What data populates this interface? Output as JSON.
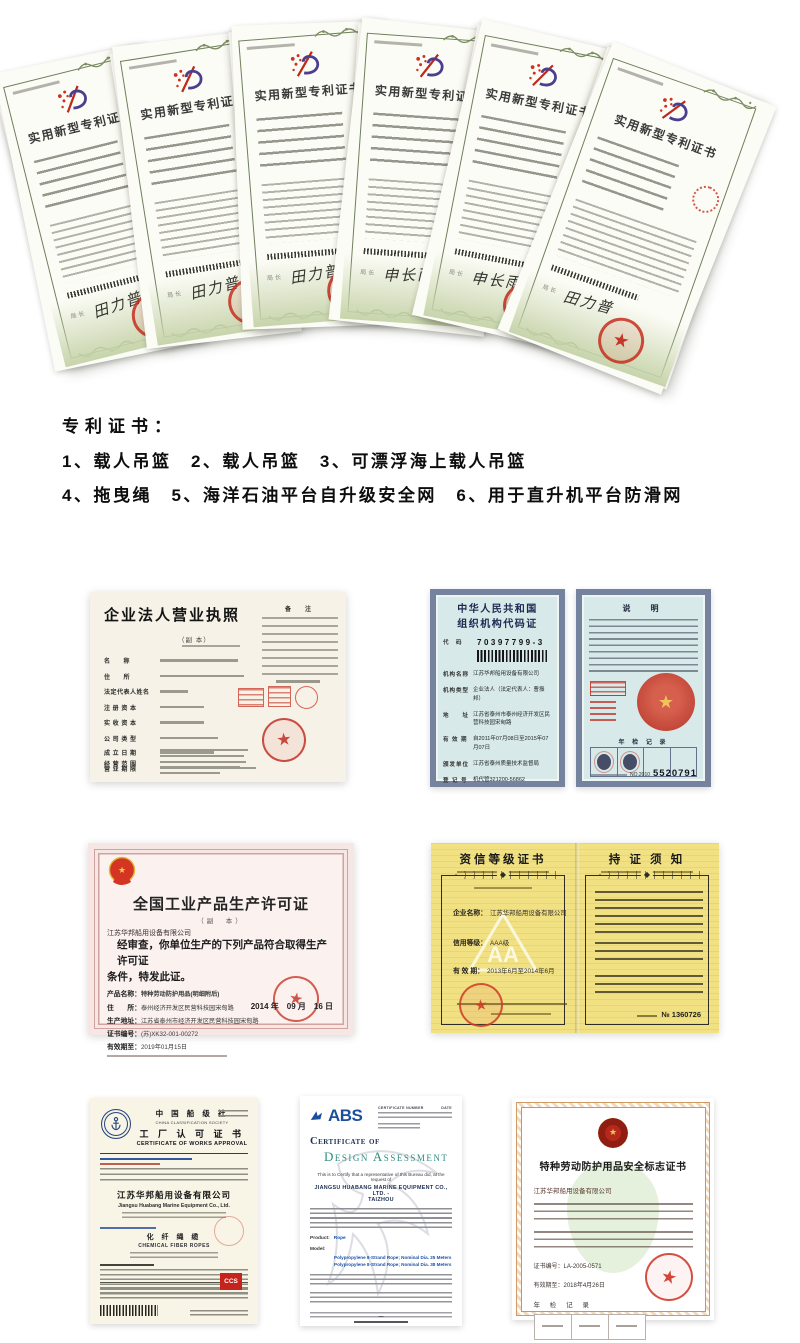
{
  "patent_stack": {
    "title": "实用新型专利证书",
    "issuer_label": "局长",
    "signature_a": "田力普",
    "signature_b": "申长雨"
  },
  "patent_list": {
    "heading": "专利证书：",
    "line1": "1、载人吊篮　2、载人吊篮　3、可漂浮海上载人吊篮",
    "line2": "4、拖曳绳　5、海洋石油平台自升级安全网　6、用于直升机平台防滑网"
  },
  "business_license": {
    "title": "企业法人营业执照",
    "copy_label": "（副  本）",
    "note_header": "备　注",
    "labels": [
      "名　　称",
      "住　　所",
      "法定代表人姓名",
      "注 册 资 本",
      "实 收 资 本",
      "公 司 类 型",
      "经 营 范 围"
    ],
    "footer_labels": [
      "成 立 日 期",
      "营 业 期 限"
    ]
  },
  "org_code_cert": {
    "title_line1": "中华人民共和国",
    "title_line2": "组织机构代码证",
    "code_label": "代　码",
    "code_value": "70397799-3",
    "labels": {
      "org_name": "机构名称",
      "org_type": "机构类型",
      "address": "地　　址",
      "validity": "有 效 期",
      "issuer": "颁发单位",
      "reg_no": "登 记 号"
    },
    "values": {
      "org_name": "江苏华邦船用设备有限公司",
      "org_type": "企业法人（法定代表人：曹振邦）",
      "address": "江苏省泰州市泰州经济开发区民营科技园宋甸路",
      "validity": "自2011年07月08日至2015年07月07日",
      "issuer": "江苏省泰州质量技术监督局",
      "reg_no": "机代管321200-56862"
    },
    "back": {
      "header": "说　明",
      "emblem_star": "★",
      "annual_label": "年 检 记 录",
      "serial_prefix": "NO.2010",
      "serial_number": "5520791"
    }
  },
  "production_license": {
    "title": "全国工业产品生产许可证",
    "copy_label": "（副　本）",
    "company": "江苏华邦船用设备有限公司",
    "statement_line1": "经审查，你单位生产的下列产品符合取得生产许可证",
    "statement_line2": "条件，特发此证。",
    "product_label": "产品名称：",
    "product_value": "特种劳动防护用品(明细附后)",
    "address_label": "住　　所：",
    "address_value": "泰州经济开发区民营科技园宋甸路",
    "site_label": "生产地址：",
    "site_value": "江苏省泰州市经济开发区民营科技园宋甸路",
    "cert_no_label": "证书编号：",
    "cert_no_value": "(苏)XK32-001-00272",
    "valid_label": "有效期至：",
    "valid_value": "2019年01月15日",
    "issue_date": "2014 年　09 月　16 日"
  },
  "credit_cert": {
    "left_title": "资信等级证书",
    "right_title": "持 证 须 知",
    "labels": {
      "company": "企业名称：",
      "grade": "信用等级：",
      "validity": "有 效 期："
    },
    "values": {
      "company": "江苏华邦船用设备有限公司",
      "grade": "AAA级",
      "validity": "2013年6月至2014年6月"
    },
    "serial": "№ 1360726"
  },
  "ccs_cert": {
    "org_cn": "中 国 船 级 社",
    "org_en": "CHINA CLASSIFICATION SOCIETY",
    "title_cn": "工 厂 认 可 证 书",
    "title_en": "CERTIFICATE OF WORKS APPROVAL",
    "company_cn": "江苏华邦船用设备有限公司",
    "company_en": "Jiangsu Huabang Marine Equipment Co., Ltd.",
    "product_cn": "化 纤 绳 缆",
    "product_en": "CHEMICAL FIBER ROPES",
    "mark": "CCS"
  },
  "abs_cert": {
    "logo": "ABS",
    "cert_no_label": "CERTIFICATE NUMBER",
    "date_label": "DATE",
    "title_line1": "Certificate of",
    "title_line2": "Design Assessment",
    "certify_line": "This is to Certify that a representative of this Bureau did, at the request of",
    "company_line1": "JIANGSU HUABANG MARINE EQUIPMENT CO., LTD. -",
    "company_line2": "TAIZHOU",
    "product_label": "Product:",
    "product_value": "Rope",
    "model_label": "Model:",
    "model_line1": "Polypropylene 8-Strand Rope; Nominal Dia. 25 Meters",
    "model_line2": "Polypropylene 8-Strand Rope; Nominal Dia. 38 Meters"
  },
  "safety_cert": {
    "title": "特种劳动防护用品安全标志证书",
    "company": "江苏华邦船用设备有限公司",
    "cert_no": "证书编号：LA-2005-0571",
    "valid": "有效期至：2018年4月26日",
    "annual_label": "年 检 记 录",
    "footer": "国家安全生产监督管理总局监制"
  },
  "colors": {
    "patent_border_green": "#6f7f5c",
    "seal_red": "#c5352a",
    "blue_cert_border": "#76839f",
    "abs_blue": "#1b4f9e",
    "abs_teal": "#2d8d7f",
    "orange_border": "#cf9258",
    "yellow_paper": "#f1e183"
  }
}
